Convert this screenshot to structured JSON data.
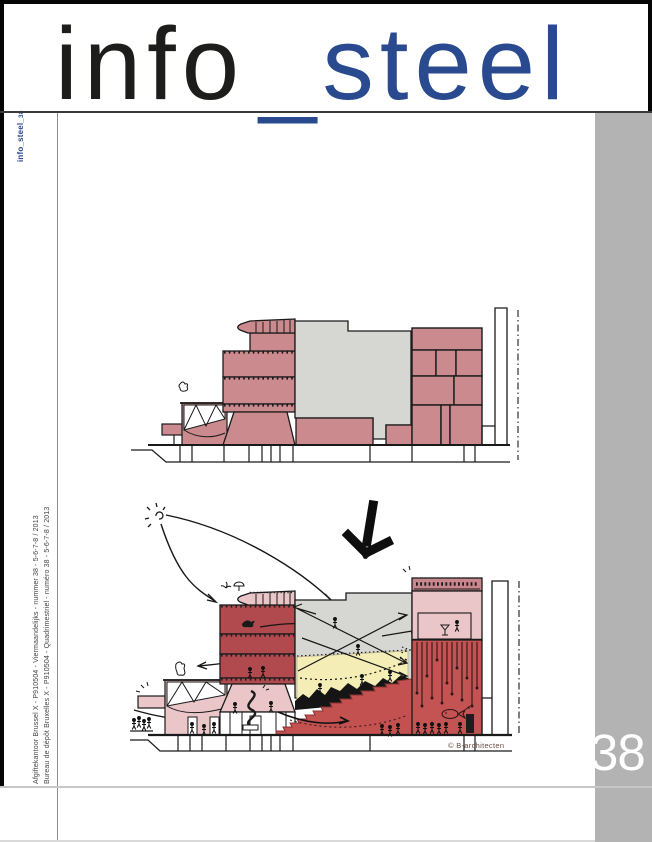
{
  "masthead": {
    "prefix": "info",
    "underscore": "_",
    "suffix": "steel"
  },
  "spine": {
    "label_prefix": "info_steel_",
    "label_number": "38"
  },
  "left_column": {
    "postal_line_nl": "Afgiftekantoor Brussel X - P910504 - Viermaandelijks - nummer 38 - 5-6-7-8 / 2013",
    "postal_line_fr": "Bureau de dépôt Bruxelles X - P910504 - Quadrimestriel - numéro 38 - 5-6-7-8 / 2013"
  },
  "sidebar": {
    "issue_number": "38"
  },
  "illustration": {
    "credit": "© B-architecten"
  },
  "colors": {
    "brand_blue": "#2a4a8f",
    "ink": "#1d1d1b",
    "sidebar_gray": "#b3b3b3",
    "pink": "#ca8a8e",
    "light_pink": "#eac6c8",
    "mid_pink": "#c9868c",
    "dark_red": "#b04a4e",
    "red": "#c25150",
    "mass_gray": "#d6d6d2",
    "yellow": "#f4eeb6"
  }
}
